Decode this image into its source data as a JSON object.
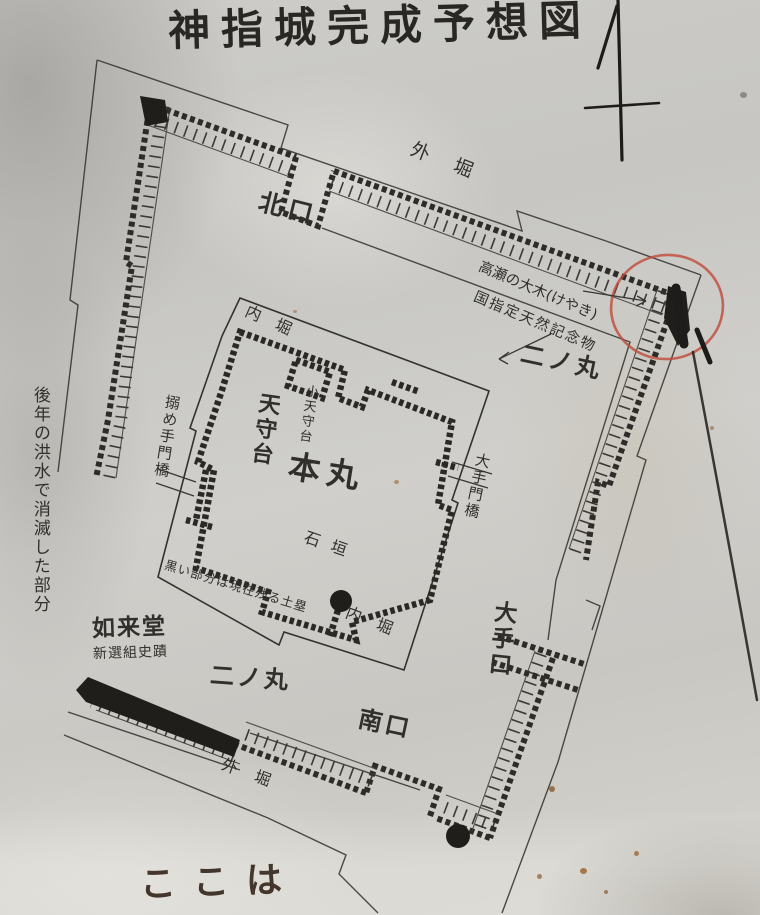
{
  "sign": {
    "title": "神指城完成予想図",
    "here_note": "ここは"
  },
  "labels": {
    "outer_moat_top": "外堀",
    "outer_moat_bottom": "外堀",
    "north_gate": "北口",
    "south_gate": "南口",
    "ote_gate": "大手口",
    "ninomaru_ne": "二ノ丸",
    "ninomaru_sw": "二ノ丸",
    "inner_moat_top": "内堀",
    "inner_moat_bottom": "内堀",
    "honmaru": "本丸",
    "tenshudai": "天守台",
    "small_tenshudai": "小天守台",
    "ishigaki": "石垣",
    "karamete_bridge": "搦め手門橋",
    "ote_bridge": "大手門橋",
    "nyoraido": "如来堂",
    "shinsengumi": "新選組史蹟"
  },
  "annotations": {
    "tree_line1": "高瀬の大木(けやき)",
    "tree_line2": "国指定天然記念物",
    "earthwork_note": "黒い部分は現在残る土塁",
    "flood_note": "後年の洪水で消滅した部分"
  },
  "colors": {
    "ink": "#2e2c28",
    "plain_line": "#3a3834",
    "red_circle": "#bf4a3a",
    "marker": "#1d1c1a",
    "paper": "#cccbc7",
    "here_ink": "#43362c"
  }
}
